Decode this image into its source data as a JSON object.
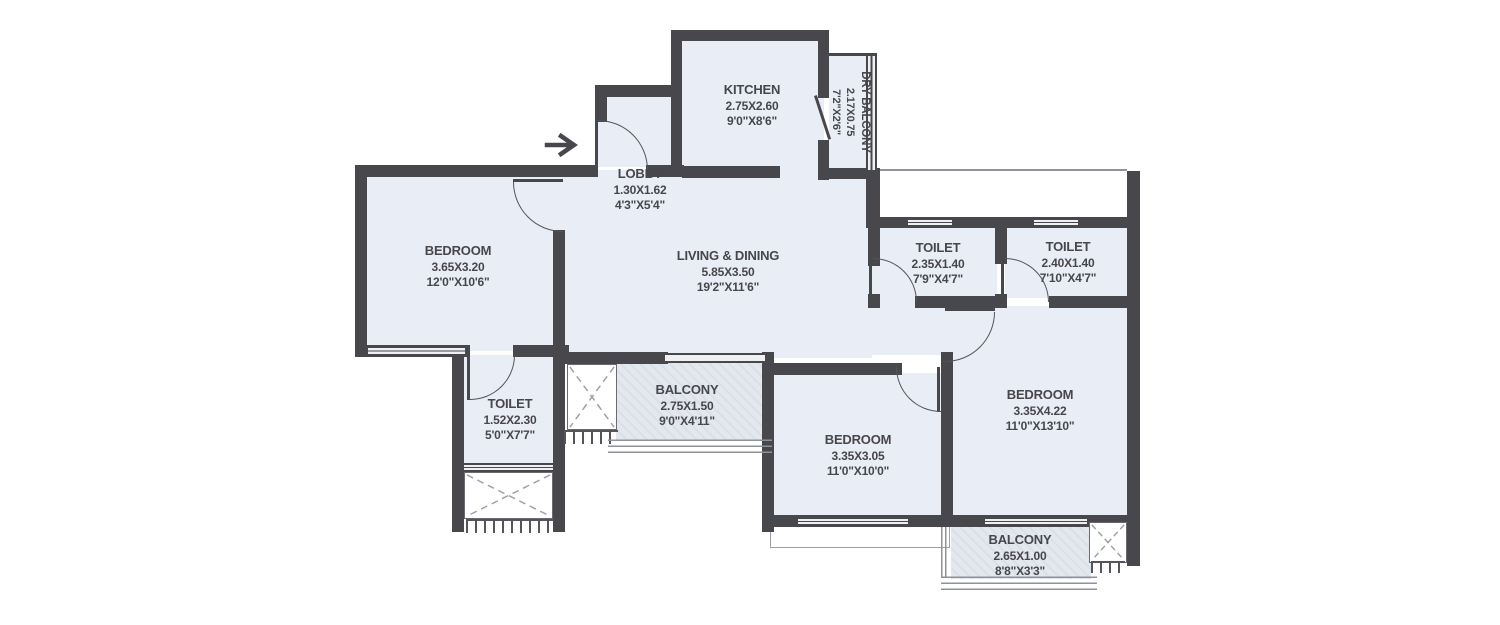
{
  "plan": {
    "type": "apartment-floor-plan",
    "colors": {
      "wall": "#48474c",
      "room_fill": "#e9edf5",
      "balcony_fill": "#e3e7ee",
      "outline": "#8f929a",
      "text": "#47464b",
      "background": "#ffffff"
    },
    "entrance": {
      "symbol": "→",
      "direction": "right"
    },
    "rooms": [
      {
        "id": "kitchen",
        "name": "KITCHEN",
        "metric": "2.75X2.60",
        "imperial": "9'0\"X8'6\""
      },
      {
        "id": "dry-balcony",
        "name": "DRY BALCONY",
        "metric": "2.17X0.75",
        "imperial": "7'2\"X2'6\""
      },
      {
        "id": "lobby",
        "name": "LOBBY",
        "metric": "1.30X1.62",
        "imperial": "4'3\"X5'4\""
      },
      {
        "id": "bedroom-left",
        "name": "BEDROOM",
        "metric": "3.65X3.20",
        "imperial": "12'0\"X10'6\""
      },
      {
        "id": "living-dining",
        "name": "LIVING & DINING",
        "metric": "5.85X3.50",
        "imperial": "19'2\"X11'6\""
      },
      {
        "id": "toilet-1",
        "name": "TOILET",
        "metric": "2.35X1.40",
        "imperial": "7'9\"X4'7\""
      },
      {
        "id": "toilet-2",
        "name": "TOILET",
        "metric": "2.40X1.40",
        "imperial": "7'10\"X4'7\""
      },
      {
        "id": "toilet-3",
        "name": "TOILET",
        "metric": "1.52X2.30",
        "imperial": "5'0\"X7'7\""
      },
      {
        "id": "balcony-mid",
        "name": "BALCONY",
        "metric": "2.75X1.50",
        "imperial": "9'0\"X4'11\""
      },
      {
        "id": "bedroom-mid",
        "name": "BEDROOM",
        "metric": "3.35X3.05",
        "imperial": "11'0\"X10'0\""
      },
      {
        "id": "bedroom-right",
        "name": "BEDROOM",
        "metric": "3.35X4.22",
        "imperial": "11'0\"X13'10\""
      },
      {
        "id": "balcony-br",
        "name": "BALCONY",
        "metric": "2.65X1.00",
        "imperial": "8'8\"X3'3\""
      }
    ]
  }
}
